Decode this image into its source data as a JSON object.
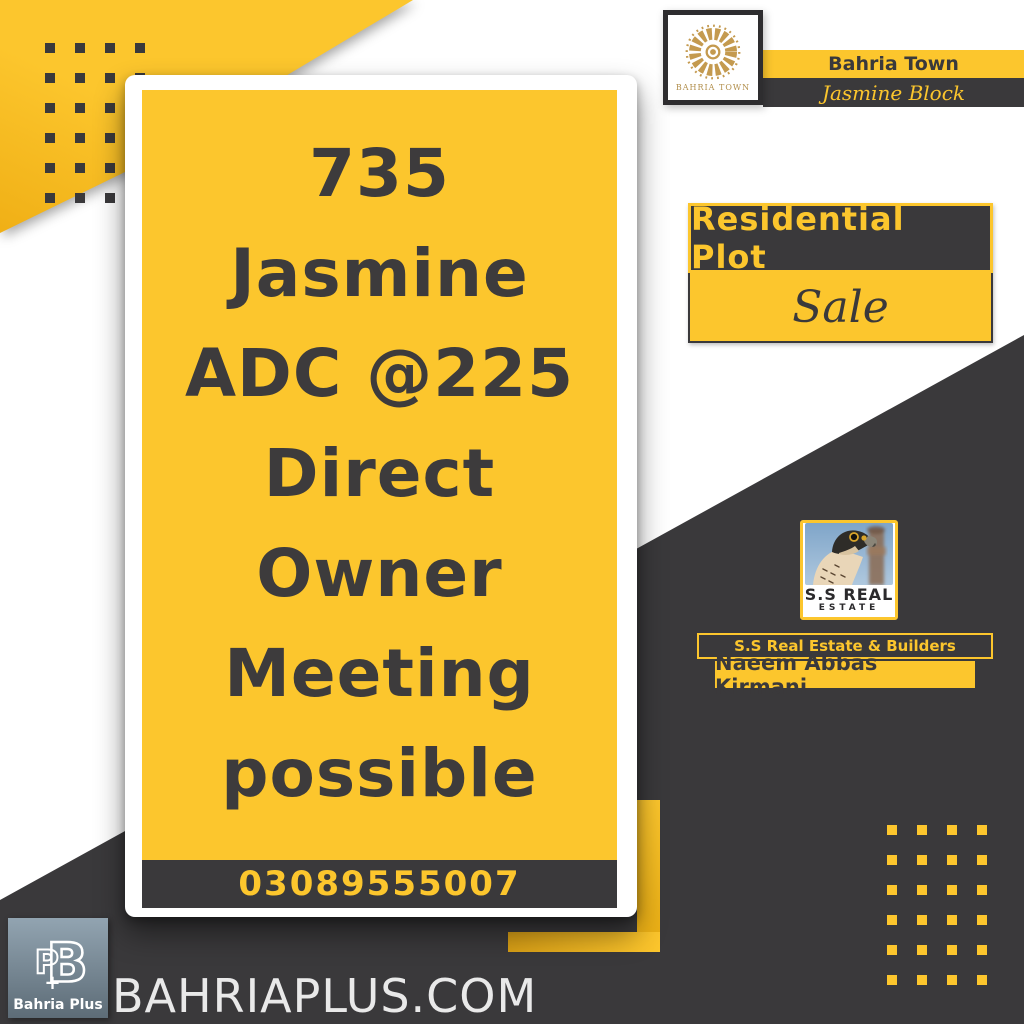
{
  "colors": {
    "yellow": "#FCC62D",
    "dark": "#3A393B",
    "gold": "#C49A4F",
    "headline_text": "#3D3B3C",
    "website_text": "#E9E9E9",
    "footer_plate_blue": "#7E93A1"
  },
  "card": {
    "headline_lines": [
      "735",
      "Jasmine",
      "ADC @225",
      "Direct",
      "Owner",
      "Meeting",
      "possible"
    ],
    "phone": "03089555007"
  },
  "brand_header": {
    "logo_caption": "BAHRIA TOWN",
    "title": "Bahria Town",
    "subtitle": "Jasmine Block"
  },
  "listing_badge": {
    "type": "Residential Plot",
    "status": "Sale"
  },
  "agency": {
    "logo_title": "S.S REAL",
    "logo_subtitle": "ESTATE",
    "company_bar": "S.S Real Estate & Builders",
    "agent_name": "Naeem Abbas Kirmani"
  },
  "footer": {
    "logo_caption": "Bahria Plus",
    "website": "BAHRIAPLUS.COM"
  }
}
